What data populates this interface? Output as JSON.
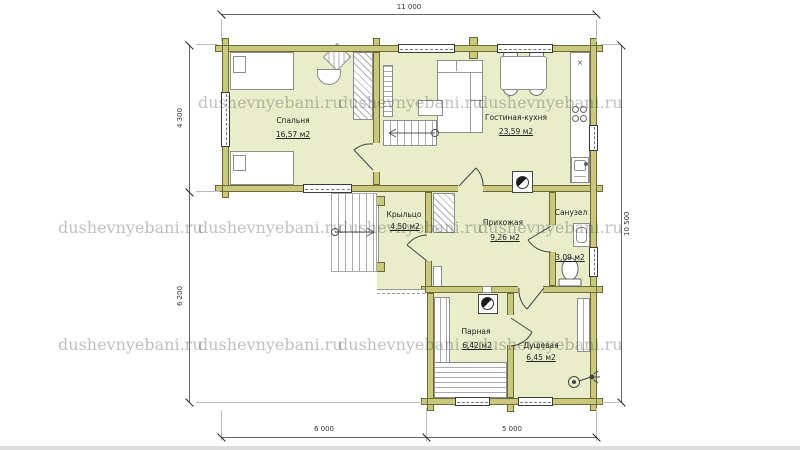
{
  "watermark": {
    "text": "dushevnyebani.ru"
  },
  "dimensions": {
    "top": "11 000",
    "left_upper": "4 300",
    "left_lower": "6 200",
    "right": "10 500",
    "bottom_left": "6 000",
    "bottom_right": "5 000"
  },
  "rooms": {
    "bedroom": {
      "name": "Спальня",
      "area": "16,57 м2"
    },
    "living_kitchen": {
      "name": "Гостиная-кухня",
      "area": "23,59 м2"
    },
    "porch": {
      "name": "Крыльцо",
      "area": "4,50 м2"
    },
    "hallway": {
      "name": "Прихожая",
      "area": "9,26 м2"
    },
    "wc": {
      "name": "Санузел",
      "area": "3,09 м2"
    },
    "steam_room": {
      "name": "Парная",
      "area": "6,42 м2"
    },
    "shower": {
      "name": "Душевая",
      "area": "6,45 м2"
    }
  },
  "kitchen": {
    "hob_marker": "×"
  },
  "colors": {
    "wall": "#c9c87c",
    "room_fill": "#e9edca",
    "background": "#ffffff"
  }
}
